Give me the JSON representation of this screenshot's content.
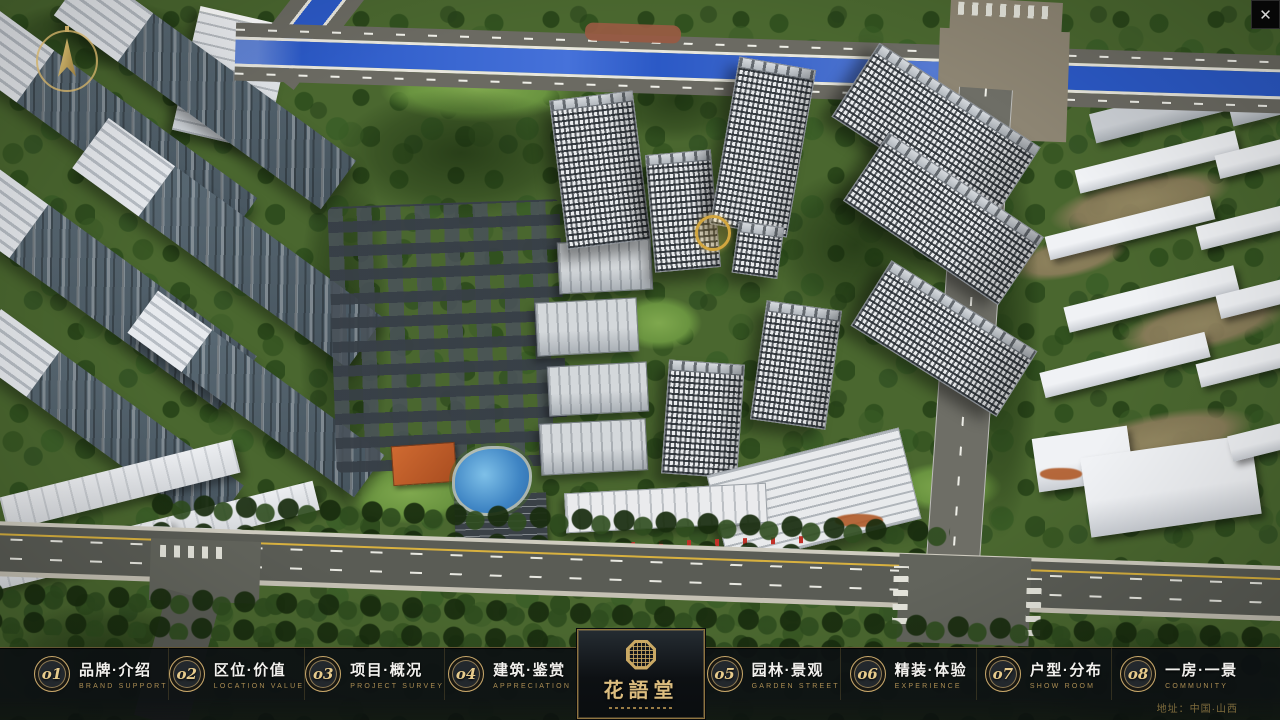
{
  "header": {
    "close": "✕"
  },
  "logo": {
    "title": "花語堂"
  },
  "menu": {
    "items": [
      {
        "num": "o1",
        "label": "品牌·介绍",
        "sub": "BRAND SUPPORT"
      },
      {
        "num": "o2",
        "label": "区位·价值",
        "sub": "LOCATION VALUE"
      },
      {
        "num": "o3",
        "label": "项目·概况",
        "sub": "PROJECT SURVEY"
      },
      {
        "num": "o4",
        "label": "建筑·鉴赏",
        "sub": "APPRECIATION"
      },
      {
        "num": "o5",
        "label": "园林·景观",
        "sub": "GARDEN STREET"
      },
      {
        "num": "o6",
        "label": "精装·体验",
        "sub": "EXPERIENCE"
      },
      {
        "num": "o7",
        "label": "户型·分布",
        "sub": "SHOW ROOM"
      },
      {
        "num": "o8",
        "label": "一房·一景",
        "sub": "COMMUNITY"
      }
    ]
  },
  "footer": {
    "address": "地址：中国·山西"
  },
  "colors": {
    "gold": "#c9a86a",
    "bar_bg": "#0c1012",
    "river": "#2b59c6",
    "ground": "#4a672f"
  }
}
